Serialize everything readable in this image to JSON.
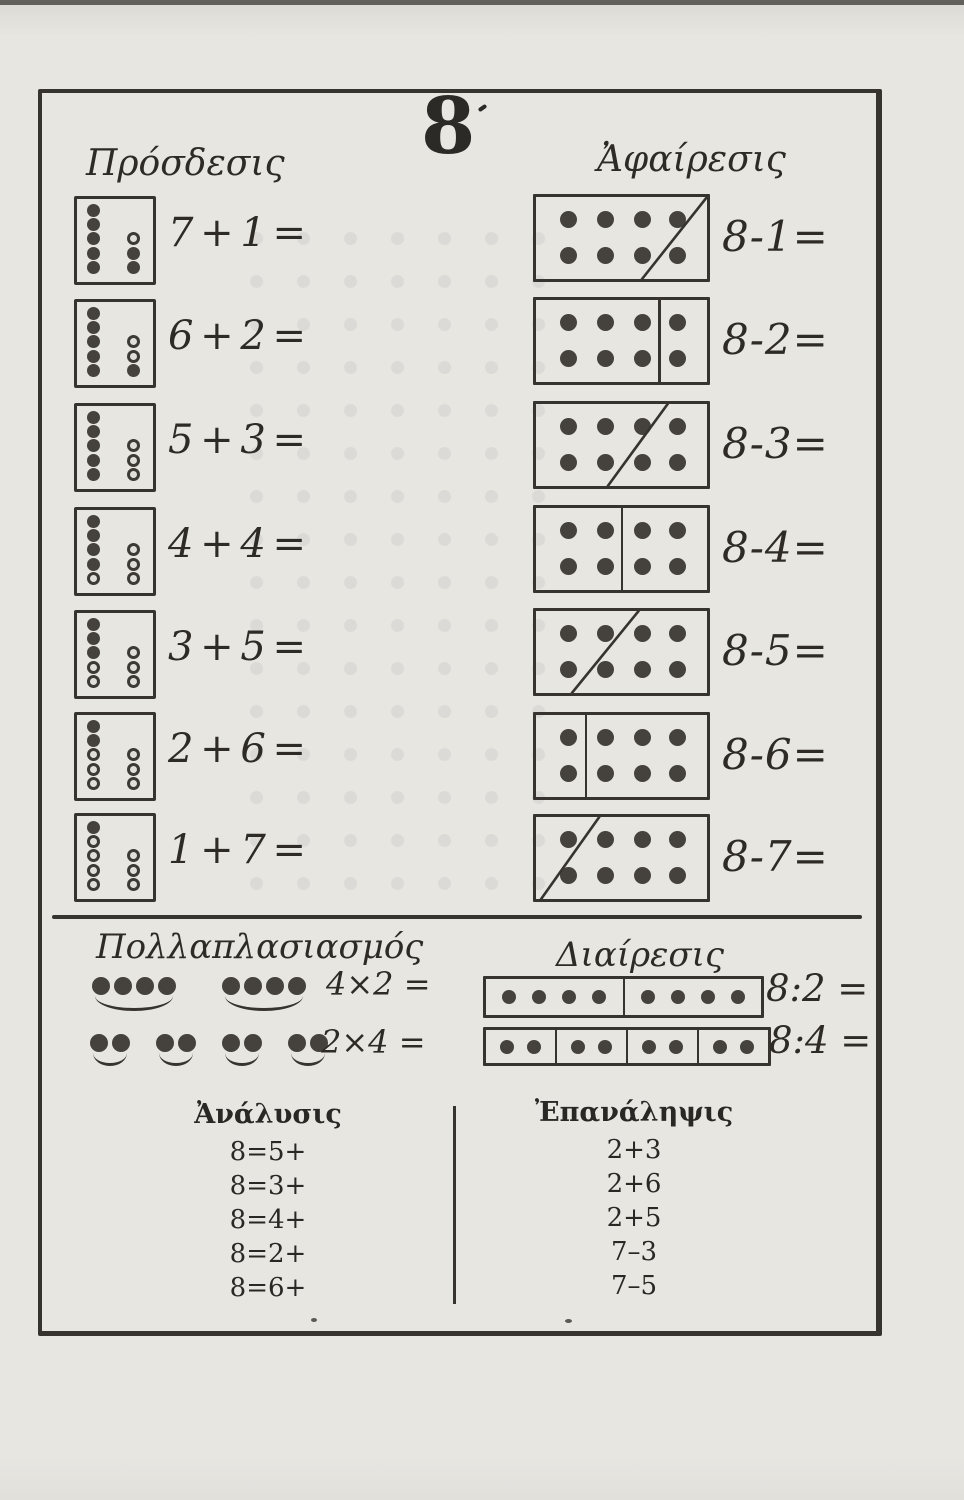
{
  "page": {
    "numeral": "8"
  },
  "colors": {
    "ink": "#37342f",
    "dot": "#45423d",
    "paper": "#e8e6e1"
  },
  "addition": {
    "title": "Πρόσδεσις",
    "rows": [
      {
        "label": "7 + 1 =",
        "left": [
          "f",
          "f",
          "f",
          "f",
          "f"
        ],
        "right": [
          "o",
          "f",
          "f"
        ]
      },
      {
        "label": "6 + 2 =",
        "left": [
          "f",
          "f",
          "f",
          "f",
          "f"
        ],
        "right": [
          "o",
          "o",
          "f"
        ]
      },
      {
        "label": "5 + 3 =",
        "left": [
          "f",
          "f",
          "f",
          "f",
          "f"
        ],
        "right": [
          "o",
          "o",
          "o"
        ]
      },
      {
        "label": "4 + 4 =",
        "left": [
          "f",
          "f",
          "f",
          "f",
          "o"
        ],
        "right": [
          "o",
          "o",
          "o"
        ]
      },
      {
        "label": "3 + 5 =",
        "left": [
          "f",
          "f",
          "f",
          "o",
          "o"
        ],
        "right": [
          "o",
          "o",
          "o"
        ]
      },
      {
        "label": "2 + 6 =",
        "left": [
          "f",
          "f",
          "o",
          "o",
          "o"
        ],
        "right": [
          "o",
          "o",
          "o"
        ]
      },
      {
        "label": "1 + 7 =",
        "left": [
          "f",
          "o",
          "o",
          "o",
          "o"
        ],
        "right": [
          "o",
          "o",
          "o"
        ]
      }
    ]
  },
  "subtraction": {
    "title": "Ἀφαίρεσις",
    "grid": {
      "rows": 2,
      "cols": 4
    },
    "rows": [
      {
        "label": "8-1=",
        "divider": {
          "type": "diagonal",
          "top": 1.0,
          "bottom": 0.62
        }
      },
      {
        "label": "8-2=",
        "divider": {
          "type": "vertical",
          "at": 0.72
        }
      },
      {
        "label": "8-3=",
        "divider": {
          "type": "diagonal",
          "top": 0.77,
          "bottom": 0.42
        }
      },
      {
        "label": "8-4=",
        "divider": {
          "type": "vertical",
          "at": 0.5
        }
      },
      {
        "label": "8-5=",
        "divider": {
          "type": "diagonal",
          "top": 0.6,
          "bottom": 0.21
        }
      },
      {
        "label": "8-6=",
        "divider": {
          "type": "vertical",
          "at": 0.29
        }
      },
      {
        "label": "8-7=",
        "divider": {
          "type": "diagonal",
          "top": 0.37,
          "bottom": 0.03
        }
      }
    ]
  },
  "multiplication": {
    "title": "Πολλαπλασιασμός",
    "rows": [
      {
        "label": "4×2 =",
        "groups": [
          4,
          4
        ]
      },
      {
        "label": "2×4 =",
        "groups": [
          2,
          2,
          2,
          2
        ]
      }
    ]
  },
  "division": {
    "title": "Διαίρεσις",
    "rows": [
      {
        "label": "8:2 =",
        "cells": [
          4,
          4
        ]
      },
      {
        "label": "8:4 =",
        "cells": [
          2,
          2,
          2,
          2
        ]
      }
    ]
  },
  "analysis": {
    "title": "Ἀνάλυσις",
    "items": [
      "8=5+",
      "8=3+",
      "8=4+",
      "8=2+",
      "8=6+"
    ]
  },
  "repetition": {
    "title": "Ἐπανάληψις",
    "items": [
      "2+3",
      "2+6",
      "2+5",
      "7–3",
      "7–5"
    ]
  }
}
